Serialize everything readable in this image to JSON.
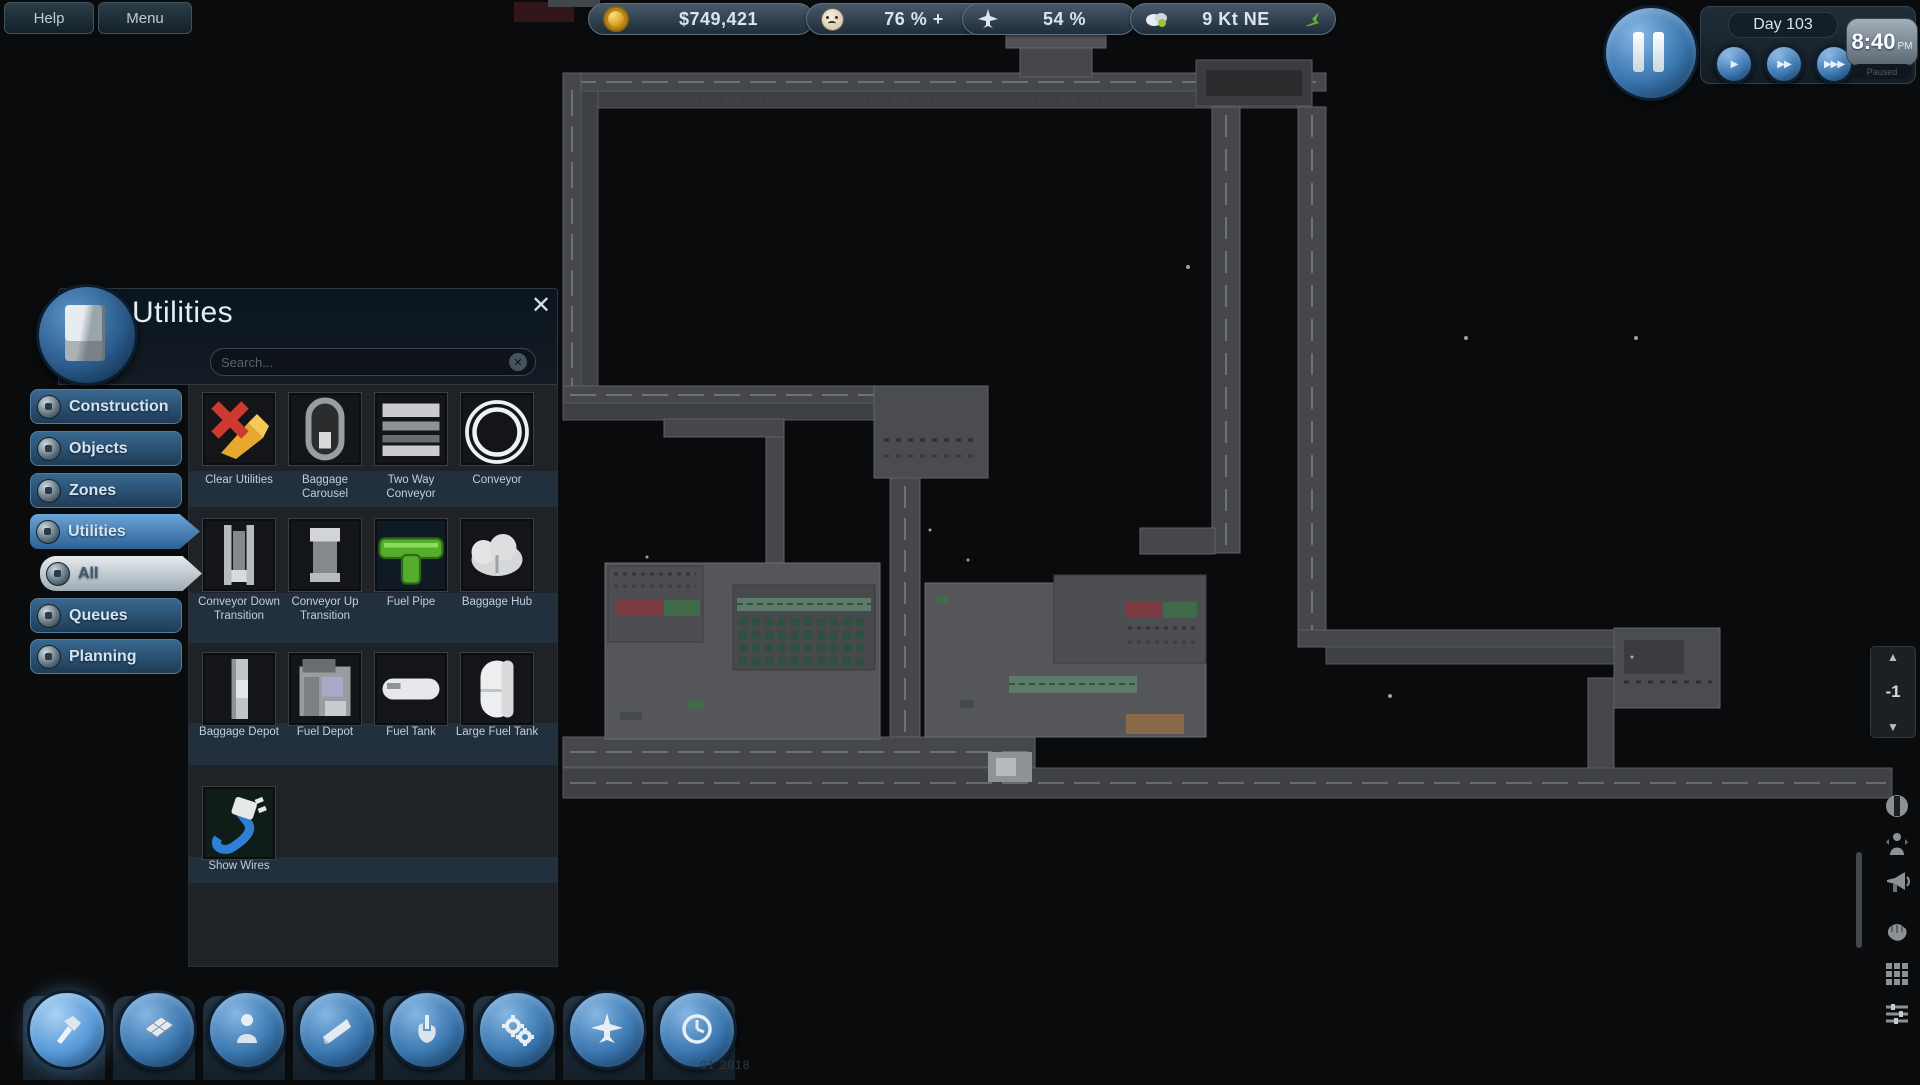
{
  "top_bar": {
    "help": "Help",
    "menu": "Menu",
    "money": "$749,421",
    "happiness": "76 % +",
    "flights": "54 %",
    "wind": "9 Kt NE"
  },
  "time_panel": {
    "day": "Day 103",
    "time": "8:40",
    "meridiem": "PM",
    "sub_label": "Paused",
    "speed1": "▶",
    "speed2": "▶▶",
    "speed3": "▶▶▶"
  },
  "panel": {
    "title": "Utilities",
    "search_placeholder": "Search...",
    "close_glyph": "✕",
    "tabs": [
      "Construction",
      "Objects",
      "Zones",
      "Utilities",
      "All",
      "Queues",
      "Planning"
    ],
    "items": [
      "Clear Utilities",
      "Baggage Carousel",
      "Two Way Conveyor",
      "Conveyor",
      "Conveyor Down Transition",
      "Conveyor Up Transition",
      "Fuel Pipe",
      "Baggage Hub",
      "Baggage Depot",
      "Fuel Depot",
      "Fuel Tank",
      "Large Fuel Tank",
      "Show Wires"
    ]
  },
  "toolbar_icons": [
    "hammer",
    "floor-tiles",
    "person",
    "ramp",
    "hand",
    "gears",
    "plane",
    "clock"
  ],
  "right_icons": [
    "circle-slot",
    "passenger",
    "megaphone",
    "glove",
    "grid",
    "sliders"
  ],
  "floor_selector": {
    "up": "▲",
    "level": "-1",
    "down": "▼"
  },
  "footer": {
    "version_text": "01 2018"
  },
  "colors": {
    "accent_blue": "#4a85c0",
    "tab_blue": "#2e5f8a",
    "money_gold": "#d9a62a",
    "wind_green": "#63b02e",
    "road_gray": "#45474a",
    "terminal_gray": "#54565a"
  }
}
